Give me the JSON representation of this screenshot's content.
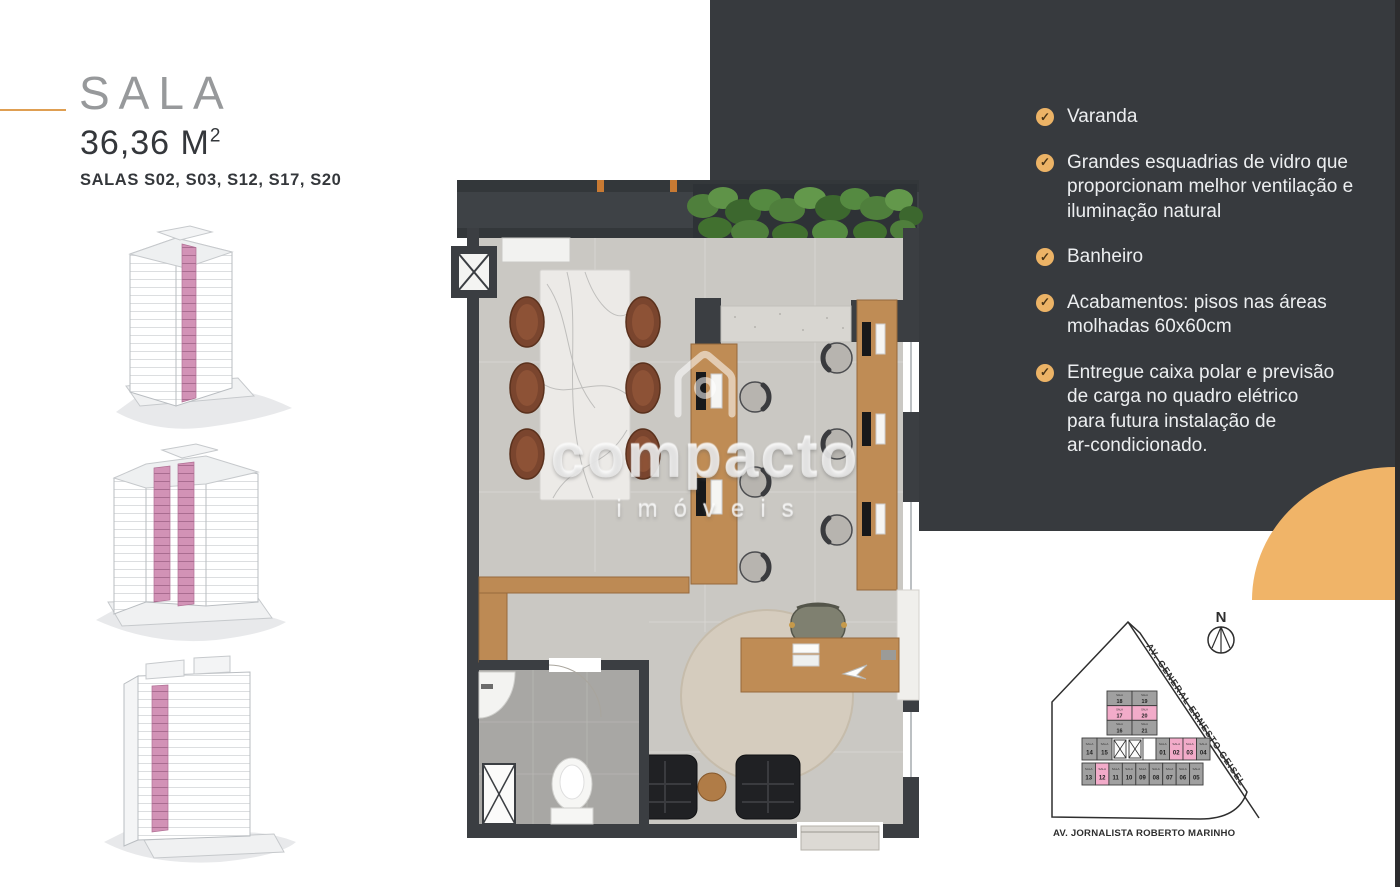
{
  "header": {
    "title": "SALA",
    "area_value": "36,36 M",
    "area_sup": "2",
    "units_line": "SALAS S02, S03, S12, S17, S20"
  },
  "features": {
    "check_glyph": "✓",
    "items": [
      "Varanda",
      "Grandes esquadrias de vidro que\nproporcionam melhor ventilação e\niluminação natural",
      "Banheiro",
      "Acabamentos: pisos nas áreas\nmolhadas 60x60cm",
      "Entregue caixa polar e previsão\nde carga no quadro elétrico\npara futura instalação de\nar-condicionado."
    ]
  },
  "watermark": {
    "brand": "compacto",
    "sub": "imóveis"
  },
  "site_plan": {
    "compass": "N",
    "street_diagonal": "AV. GENERAL ERNESTO GEISEL",
    "street_bottom": "AV. JORNALISTA ROBERTO MARINHO",
    "cell_label": "SALA",
    "highlighted_units": [
      "17",
      "20",
      "02",
      "03",
      "12"
    ],
    "top_block_rows": [
      [
        "18",
        "19"
      ],
      [
        "17",
        "20"
      ],
      [
        "16",
        "21"
      ]
    ],
    "middle_row_left": [
      "14",
      "15"
    ],
    "middle_row_right": [
      "01",
      "02",
      "03",
      "04"
    ],
    "bottom_row": [
      "13",
      "12",
      "11",
      "10",
      "09",
      "08",
      "07",
      "06",
      "05"
    ]
  },
  "colors": {
    "accent_orange": "#F0B468",
    "panel_dark": "#373A3E",
    "unit_pink": "#F2ABC9",
    "unit_gray": "#A0A0A0",
    "building_pink": "#D292B6"
  }
}
